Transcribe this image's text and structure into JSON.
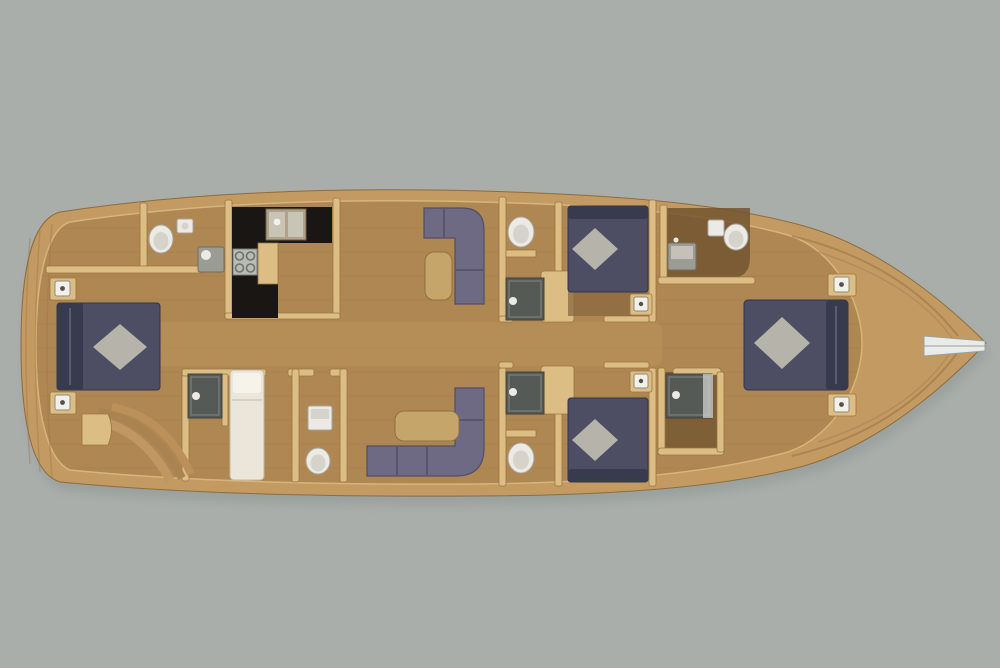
{
  "scene": {
    "kind": "yacht-lower-deck-floor-plan",
    "orientation": "bow-right-stern-left",
    "background": "#a9aeab"
  },
  "colors": {
    "background": "#a9aeab",
    "shadow": "#8f9693",
    "hull_rim": "#c39a62",
    "floor": "#ae8752",
    "floor_dark": "#73552f",
    "corridor": "#c49c64",
    "wall": "#dcbe85",
    "bed": "#4d4e63",
    "bed_head": "#383a4d",
    "pillow": "#b5b3aa",
    "sofa": "#6e6a84",
    "sofa_edge": "#524e66",
    "table": "#c6a56b",
    "counter": "#191614",
    "stove": "#b9bcb4",
    "sink_unit": "#b3a287",
    "basin": "#c8c4b6",
    "vanity": "#9b9c94",
    "vanity_top": "#c3c1b8",
    "shower": "#565a56",
    "fixture_white": "#eceae4",
    "fixture_inner": "#d6d3ca",
    "crew_bed": "#eae6da",
    "crew_pillow": "#f6f3ea",
    "lamp": "#f2f0ea",
    "bench": "#8a6840",
    "bow_notch": "#e9ebe8",
    "grain": "#8f6c3e"
  },
  "rooms": [
    {
      "id": "aft-deck",
      "items": [
        "transom-steps"
      ]
    },
    {
      "id": "master-cabin-aft",
      "items": [
        "double-bed",
        "diamond-pillow",
        "nightstand",
        "nightstand",
        "curved-steps",
        "bench"
      ]
    },
    {
      "id": "bathroom-aft",
      "items": [
        "toilet",
        "washbasin",
        "vanity"
      ]
    },
    {
      "id": "galley",
      "items": [
        "l-counter",
        "double-sink",
        "stove-4-burner"
      ]
    },
    {
      "id": "shower-room-aft",
      "items": [
        "shower"
      ]
    },
    {
      "id": "crew-cabin",
      "items": [
        "single-bed"
      ]
    },
    {
      "id": "wc-aft",
      "items": [
        "cabinet",
        "toilet"
      ]
    },
    {
      "id": "salon",
      "items": [
        "l-sofa",
        "side-table",
        "l-sofa",
        "side-table"
      ]
    },
    {
      "id": "guest-bathroom-port",
      "items": [
        "toilet",
        "shelf",
        "shower"
      ]
    },
    {
      "id": "guest-cabin-port",
      "items": [
        "double-bed",
        "diamond-pillow",
        "nightstand",
        "wardrobe"
      ]
    },
    {
      "id": "guest-bathroom-starboard",
      "items": [
        "shower",
        "shelf",
        "toilet"
      ]
    },
    {
      "id": "guest-cabin-starboard",
      "items": [
        "double-bed",
        "diamond-pillow",
        "nightstand",
        "wardrobe"
      ]
    },
    {
      "id": "bathroom-bow",
      "items": [
        "vanity",
        "cabinet",
        "toilet"
      ]
    },
    {
      "id": "shower-room-bow",
      "items": [
        "shower",
        "glass-door"
      ]
    },
    {
      "id": "vip-cabin-bow",
      "items": [
        "double-bed",
        "diamond-pillow",
        "nightstand",
        "nightstand"
      ]
    },
    {
      "id": "foredeck",
      "items": [
        "anchor-slot"
      ]
    }
  ],
  "counts": {
    "double_beds": 4,
    "single_beds": 1,
    "toilets": 5,
    "showers": 4,
    "sofas": 2
  }
}
